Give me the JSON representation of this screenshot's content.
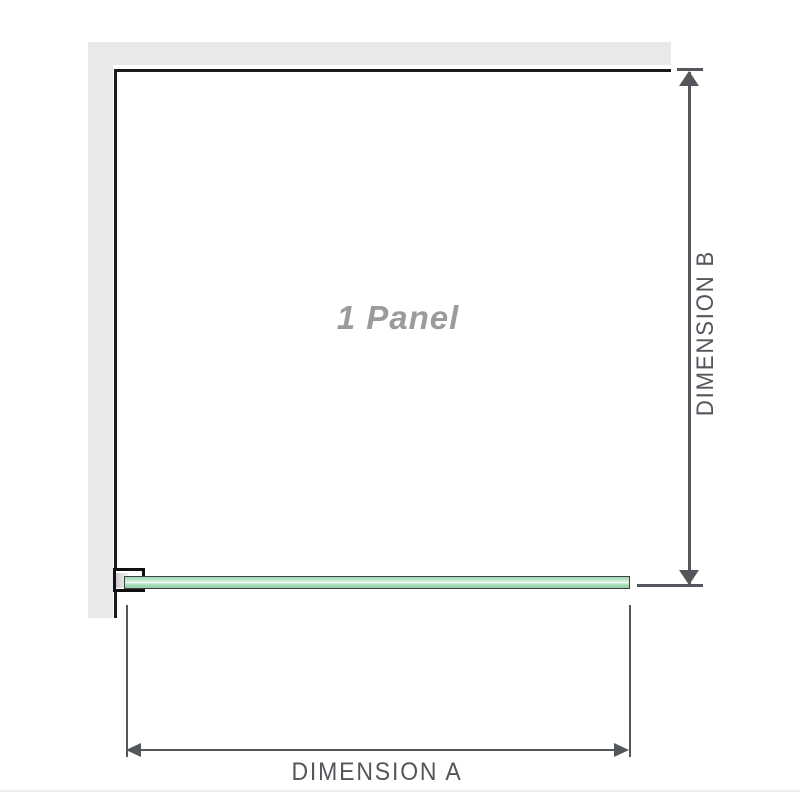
{
  "diagram": {
    "panel_label": "1 Panel",
    "dimension_a": {
      "label": "DIMENSION A"
    },
    "dimension_b": {
      "label": "DIMENSION B"
    }
  },
  "colors": {
    "background": "#ffffff",
    "wall_gray": "#e9e9e9",
    "panel_outline_black": "#1a1a1a",
    "dimension_gray": "#53565a",
    "panel_label_gray": "#9b9b9b",
    "glass_green": "#a6dbb4",
    "glass_highlight": "#eef9f1",
    "bracket_black": "#101010",
    "bottom_divider": "#f1eeea"
  }
}
